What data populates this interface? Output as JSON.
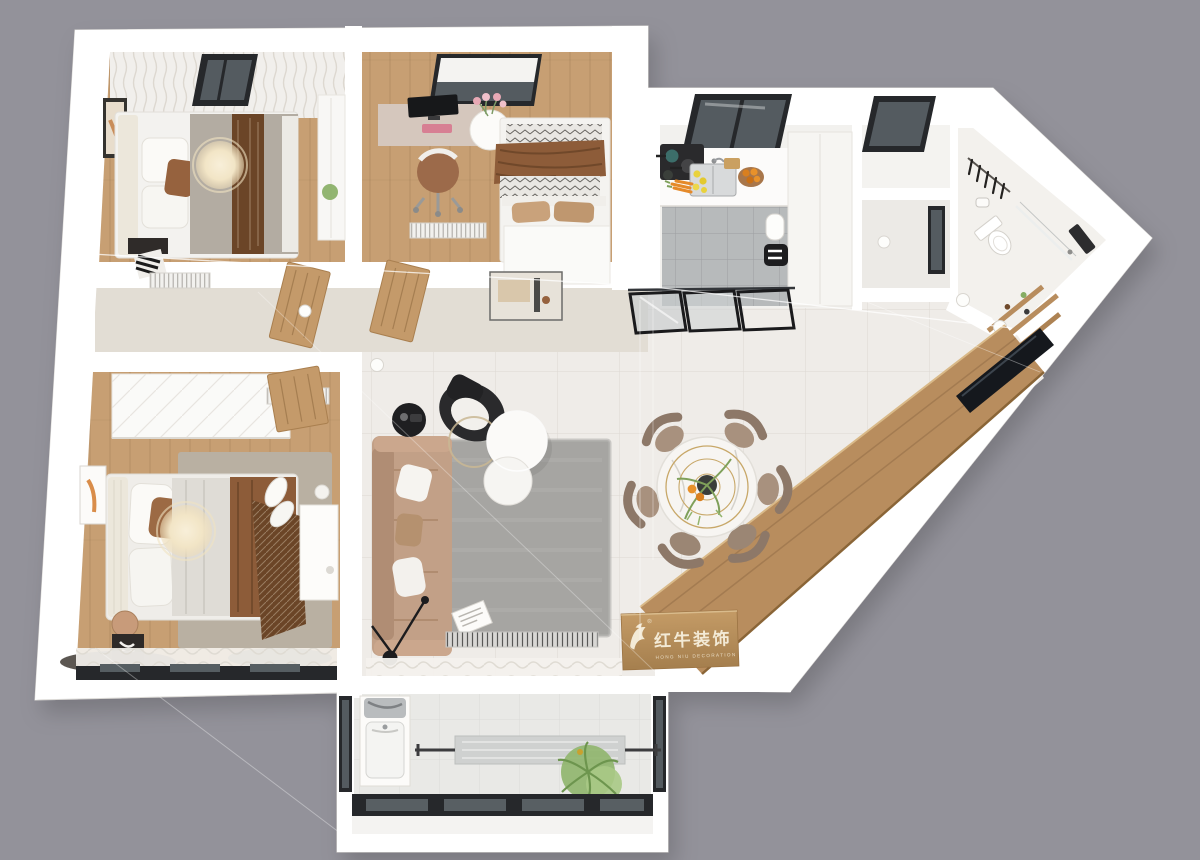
{
  "logo": {
    "zh": "红牛装饰",
    "en": "HONG NIU DECORATION",
    "registered": "®"
  },
  "icons": {
    "brand": "bull-icon"
  },
  "colors": {
    "background": "#93929a",
    "wall": "#ffffff",
    "wood_floor": "#c79f73",
    "wood_floor_pale": "#e2ddd4",
    "tile_floor": "#efece8",
    "kitchen_tile": "#b7babb",
    "balcony_tile": "#e9e9e6",
    "cabinet_wood": "#b88d5e",
    "logo_face_wood": "#b08a58",
    "sofa": "#c2a087",
    "rug_gray": "#a6a5a2",
    "rug_greige": "#b9b0a2",
    "duvet_brown": "#8d5c39",
    "throw_brown": "#6b4527",
    "dining_chair": "#a8917e",
    "window_frame": "#26282b",
    "glass": "#545b60",
    "gold_accent": "#c8a869",
    "plant_green": "#86ad63",
    "lamp_glow": "#f4e9cd",
    "logo_text": "#f3ead6"
  }
}
